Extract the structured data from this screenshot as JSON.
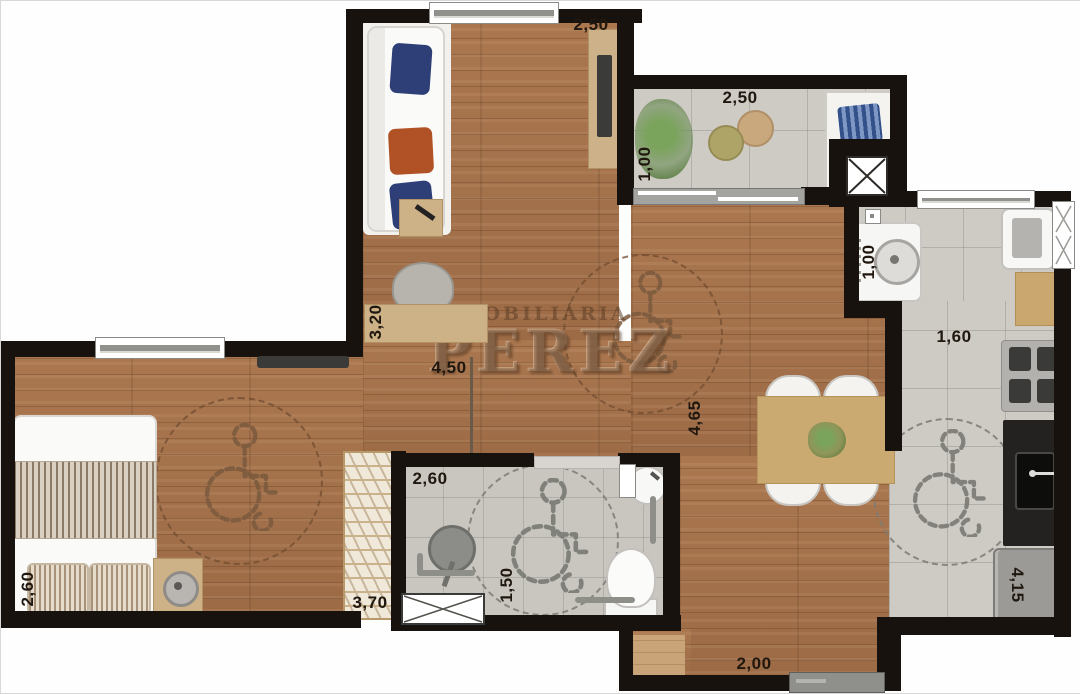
{
  "watermark": {
    "line1": "IMOBILIÁRIA",
    "line2": "PEREZ"
  },
  "dimensions": {
    "living_width": "2,50",
    "balcony_width": "2,50",
    "balcony_depth": "1,00",
    "living_depth": "3,20",
    "hall_length": "4,50",
    "social_depth": "4,65",
    "laundry_width": "1,00",
    "kitchen_width": "1,60",
    "bedroom_width": "2,60",
    "wardrobe_length": "3,70",
    "bathroom_width": "2,60",
    "bathroom_depth": "1,50",
    "kitchen_depth": "4,15",
    "entry_width": "2,00"
  },
  "icons": {
    "wheelchair": "accessible-turning-area",
    "shaft_x": "duct-shaft",
    "shower_box": "shower-area"
  },
  "colors": {
    "wall": "#17120e",
    "wood_floor": "#a5744e",
    "tile_floor": "#cecbc5",
    "cushion_blue": "#2e3f77",
    "cushion_rust": "#b05226",
    "counter_black": "#232220"
  }
}
